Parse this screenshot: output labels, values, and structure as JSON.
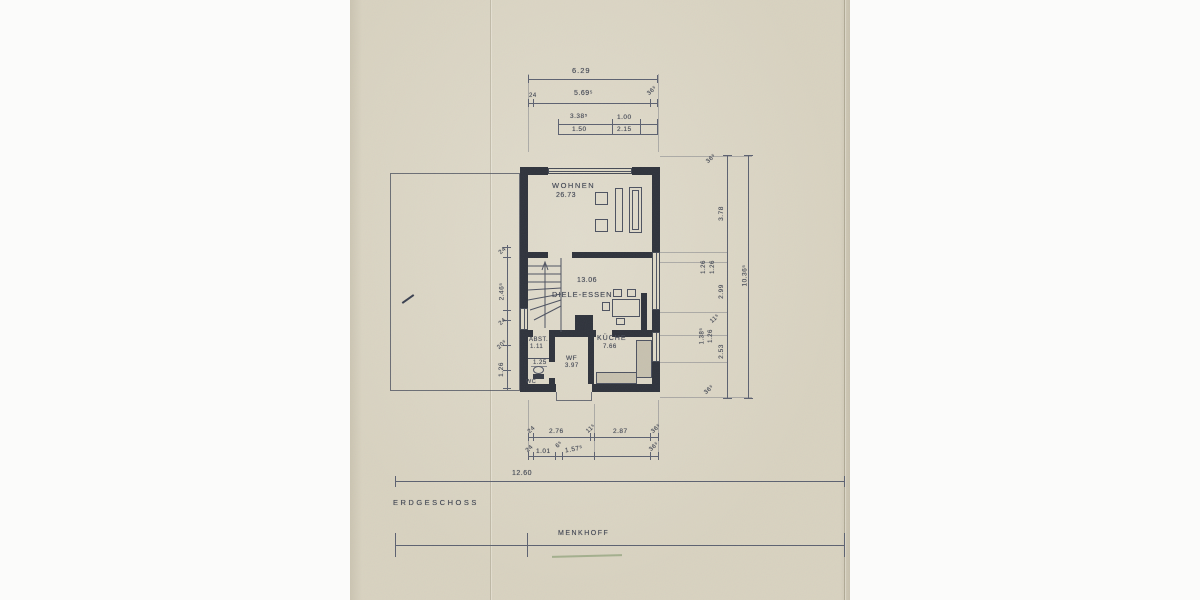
{
  "drawing": {
    "floor_label": "ERDGESCHOSS",
    "name_label": "MENKHOFF"
  },
  "rooms": {
    "wohnen_name": "WOHNEN",
    "wohnen_area": "26.73",
    "diele_area": "13.06",
    "diele_name": "DIELE-ESSEN",
    "abst_name": "ABST.",
    "abst_area": "1.11",
    "abst_width": "1.25",
    "wc_name": "WC",
    "wf_name": "WF",
    "wf_area": "3.97",
    "kueche_name": "KÜCHE",
    "kueche_area": "7.66"
  },
  "dims": {
    "top_total": "6.29",
    "top_24": "24",
    "top_5695": "5.69⁵",
    "top_365": "36⁵",
    "top_3385": "3.38⁵",
    "top_100": "1.00",
    "top_150": "1.50",
    "top_215": "2.15",
    "right_365_top": "36⁵",
    "right_378": "3.78",
    "right_126a": "1.26",
    "right_126b": "1.26",
    "right_299": "2.99",
    "right_115": "11⁵",
    "right_1385": "1.38⁵",
    "right_126c": "1.26",
    "right_253": "2.53",
    "right_365_bot": "36⁵",
    "right_total": "10.36⁵",
    "left_24a": "24",
    "left_2465": "2.46⁵",
    "left_24b": "24",
    "left_205": "20⁵",
    "left_126": "1.26",
    "bot1_24": "24",
    "bot1_276": "2.76",
    "bot1_115": "11⁵",
    "bot1_287": "2.87",
    "bot1_365": "36⁵",
    "bot2_24": "24",
    "bot2_101": "1.01",
    "bot2_65": "6⁵",
    "bot2_1575": "1.57⁵",
    "bot2_365": "36⁵",
    "overall_width": "12.60"
  }
}
